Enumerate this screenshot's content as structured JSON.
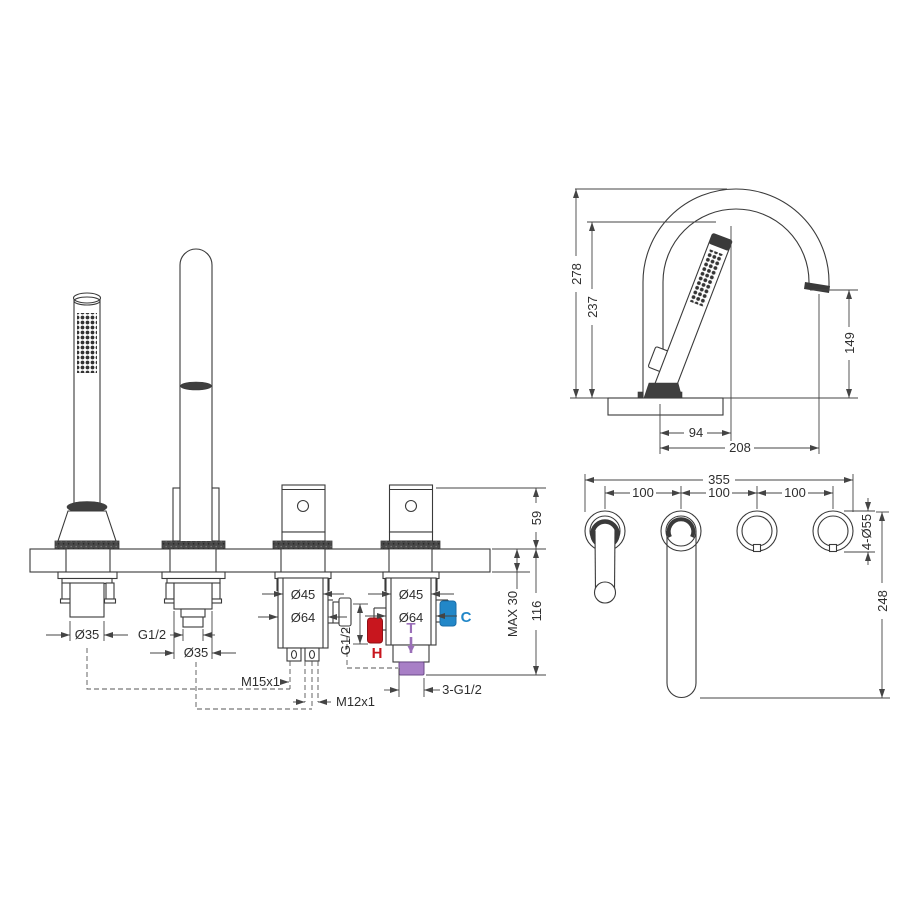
{
  "drawing": {
    "front": {
      "hole1_dia": "Ø35",
      "hole2_thread": "G1/2",
      "hole2_dia": "Ø35",
      "valve3_dia_top": "Ø45",
      "valve3_dia_bottom": "Ø64",
      "valve4_dia_top": "Ø45",
      "valve4_dia_bottom": "Ø64",
      "m15": "M15x1",
      "m12": "M12x1",
      "side_port_thread": "G1/2",
      "hot": "H",
      "mix": "T",
      "cold": "C",
      "outlet_thread": "3-G1/2",
      "dim_handle_height": "59",
      "dim_deck_max": "MAX 30",
      "dim_below_deck": "116"
    },
    "side": {
      "dim_total_height": "278",
      "dim_handshower_height": "237",
      "dim_spout_height": "149",
      "dim_handshower_offset": "94",
      "dim_spout_reach": "208"
    },
    "plan": {
      "dim_overall": "355",
      "dim_spacing_1": "100",
      "dim_spacing_2": "100",
      "dim_spacing_3": "100",
      "dim_holes": "4-Ø55",
      "dim_depth": "248"
    },
    "colors": {
      "hot": "#c8161e",
      "cold": "#2287c8",
      "mix": "#9a6fb8",
      "mix_light": "#a87fc6",
      "line": "#3a3a3a"
    }
  }
}
